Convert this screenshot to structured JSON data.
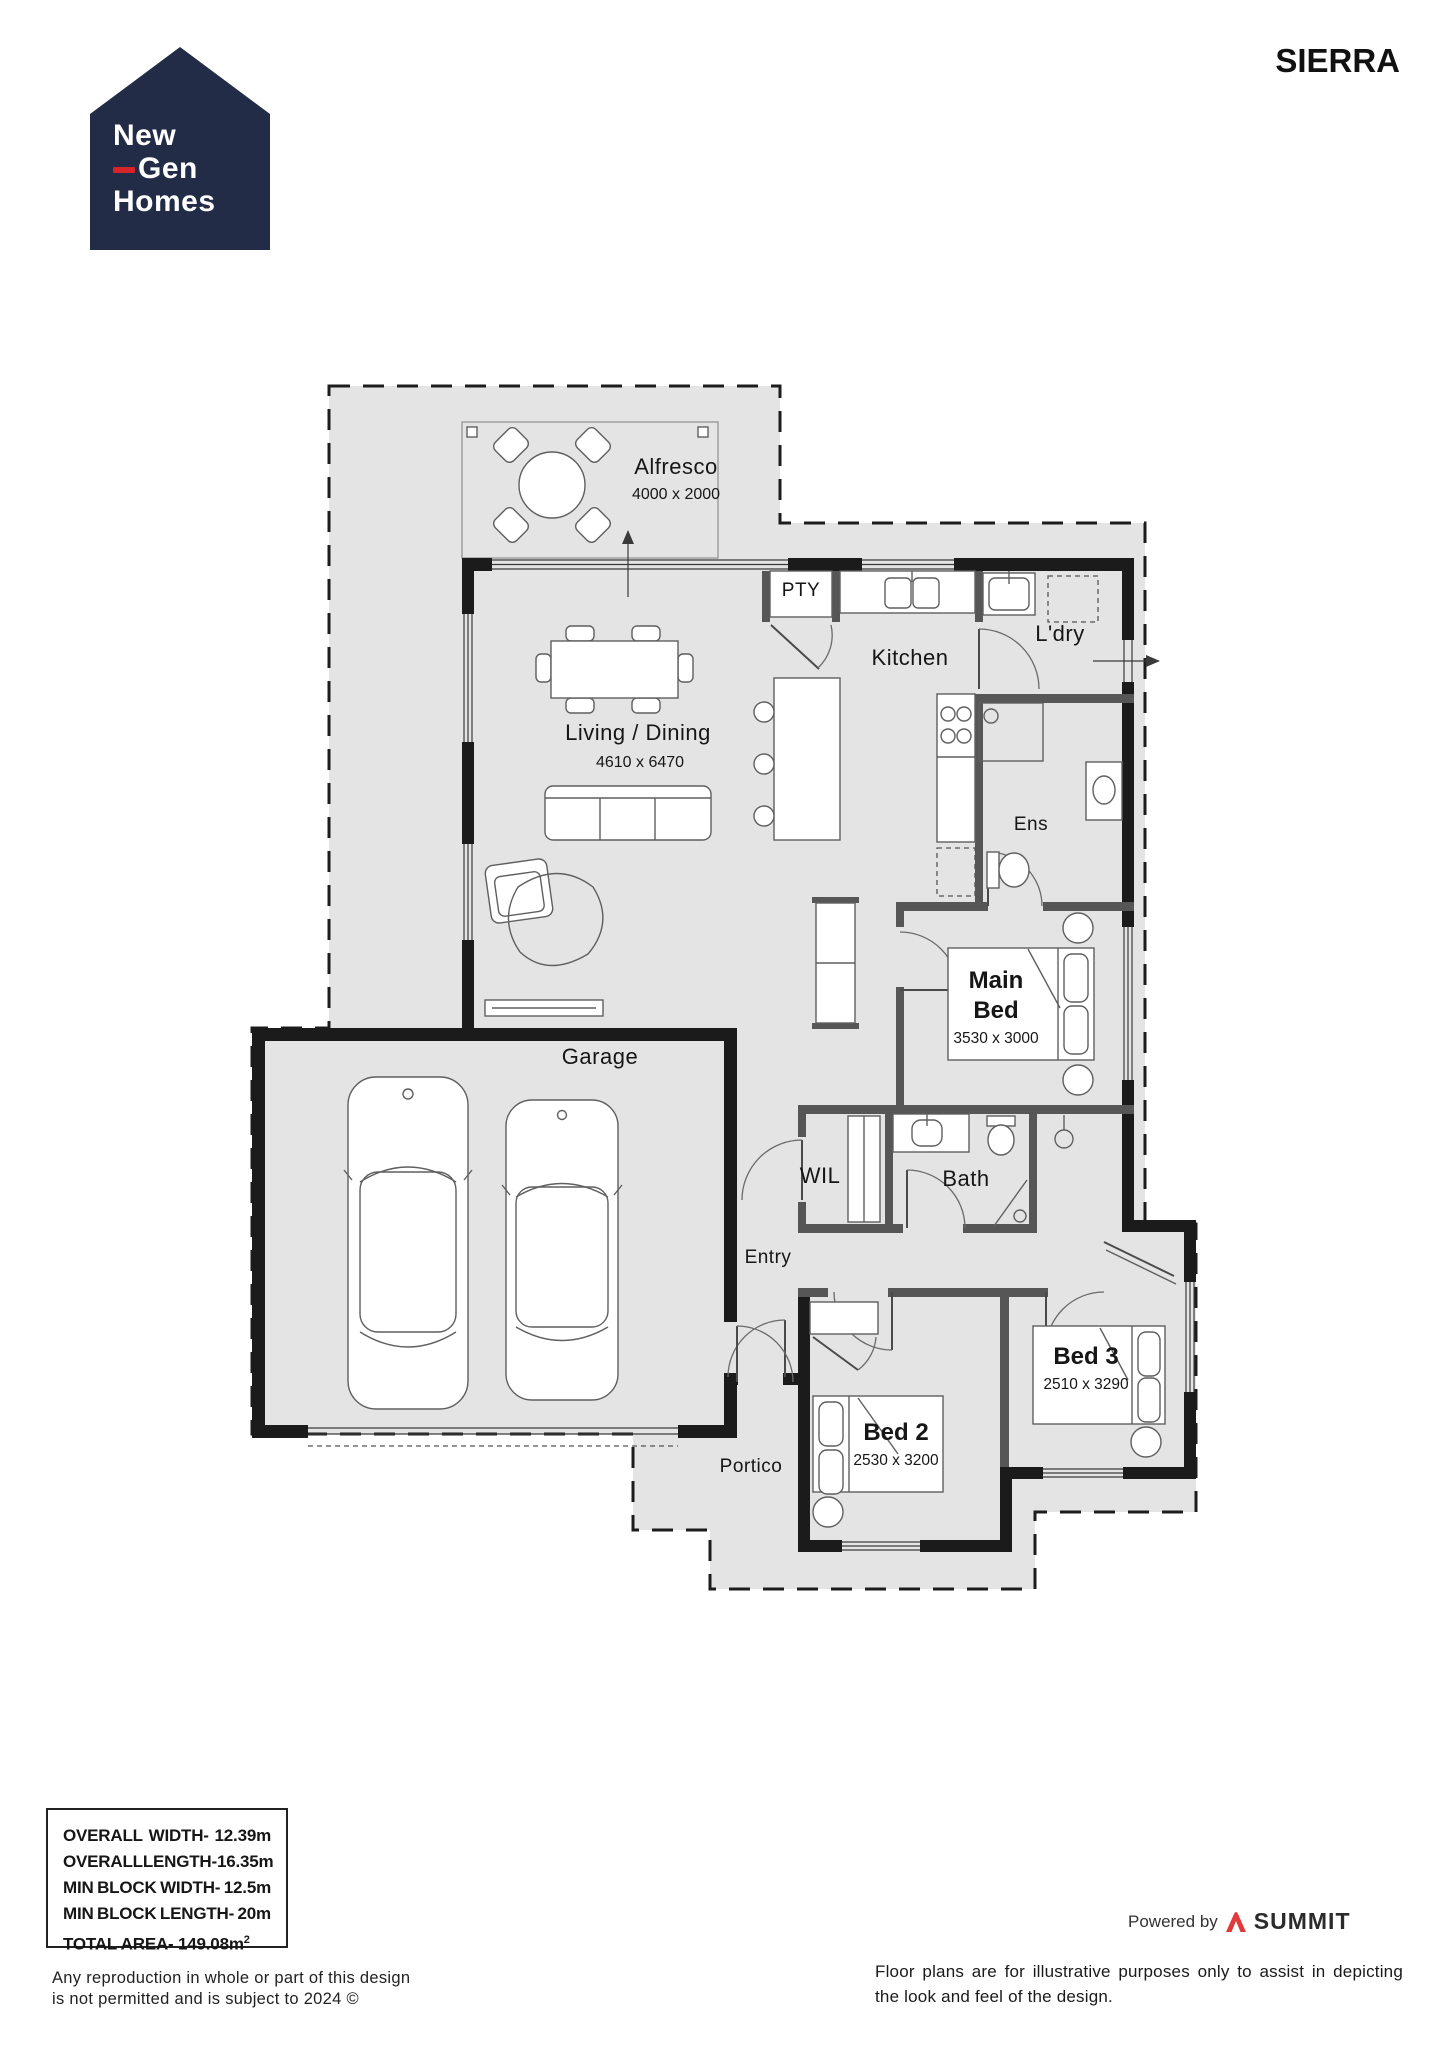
{
  "colors": {
    "logo_navy": "#232c47",
    "logo_red": "#d8232a",
    "summit_red": "#e23a3a",
    "slab_gray": "#e4e4e4",
    "wall_black": "#1b1b1b"
  },
  "header": {
    "logo": {
      "word1": "New",
      "word2": "Gen",
      "word3": "Homes"
    },
    "design_name": "SIERRA"
  },
  "plan": {
    "rooms": {
      "alfresco": {
        "label": "Alfresco",
        "dim": "4000 x 2000"
      },
      "pty": {
        "label": "PTY"
      },
      "kitchen": {
        "label": "Kitchen"
      },
      "ldry": {
        "label": "L'dry"
      },
      "living": {
        "label": "Living / Dining",
        "dim": "4610 x 6470"
      },
      "ens": {
        "label": "Ens"
      },
      "main_bed": {
        "label": "Main",
        "label2": "Bed",
        "dim": "3530 x 3000"
      },
      "garage": {
        "label": "Garage"
      },
      "wil": {
        "label": "WIL"
      },
      "bath": {
        "label": "Bath"
      },
      "entry": {
        "label": "Entry"
      },
      "bed3": {
        "label": "Bed 3",
        "dim": "2510 x 3290"
      },
      "bed2": {
        "label": "Bed 2",
        "dim": "2530 x 3200"
      },
      "portico": {
        "label": "Portico"
      }
    }
  },
  "specs": {
    "r1": {
      "a": "OVERALL",
      "b": "WIDTH-",
      "c": "12.39m"
    },
    "r2": {
      "a": "OVERALL",
      "b": "LENGTH-",
      "c": "16.35m"
    },
    "r3": {
      "a": "MIN",
      "b": "BLOCK",
      "c": "WIDTH-",
      "d": "12.5m"
    },
    "r4": {
      "a": "MIN",
      "b": "BLOCK",
      "c": "LENGTH-",
      "d": "20m"
    },
    "r5": {
      "text": "TOTAL AREA- 149.08m",
      "sup": "2"
    }
  },
  "footer": {
    "copyright_line1": "Any reproduction in whole or part of this design",
    "copyright_line2": "is not permitted and is subject to 2024 ©",
    "powered_by": "Powered by",
    "summit": "SUMMIT",
    "disclaimer": "Floor plans are for illustrative purposes only to assist in depicting the look and feel of the design."
  }
}
